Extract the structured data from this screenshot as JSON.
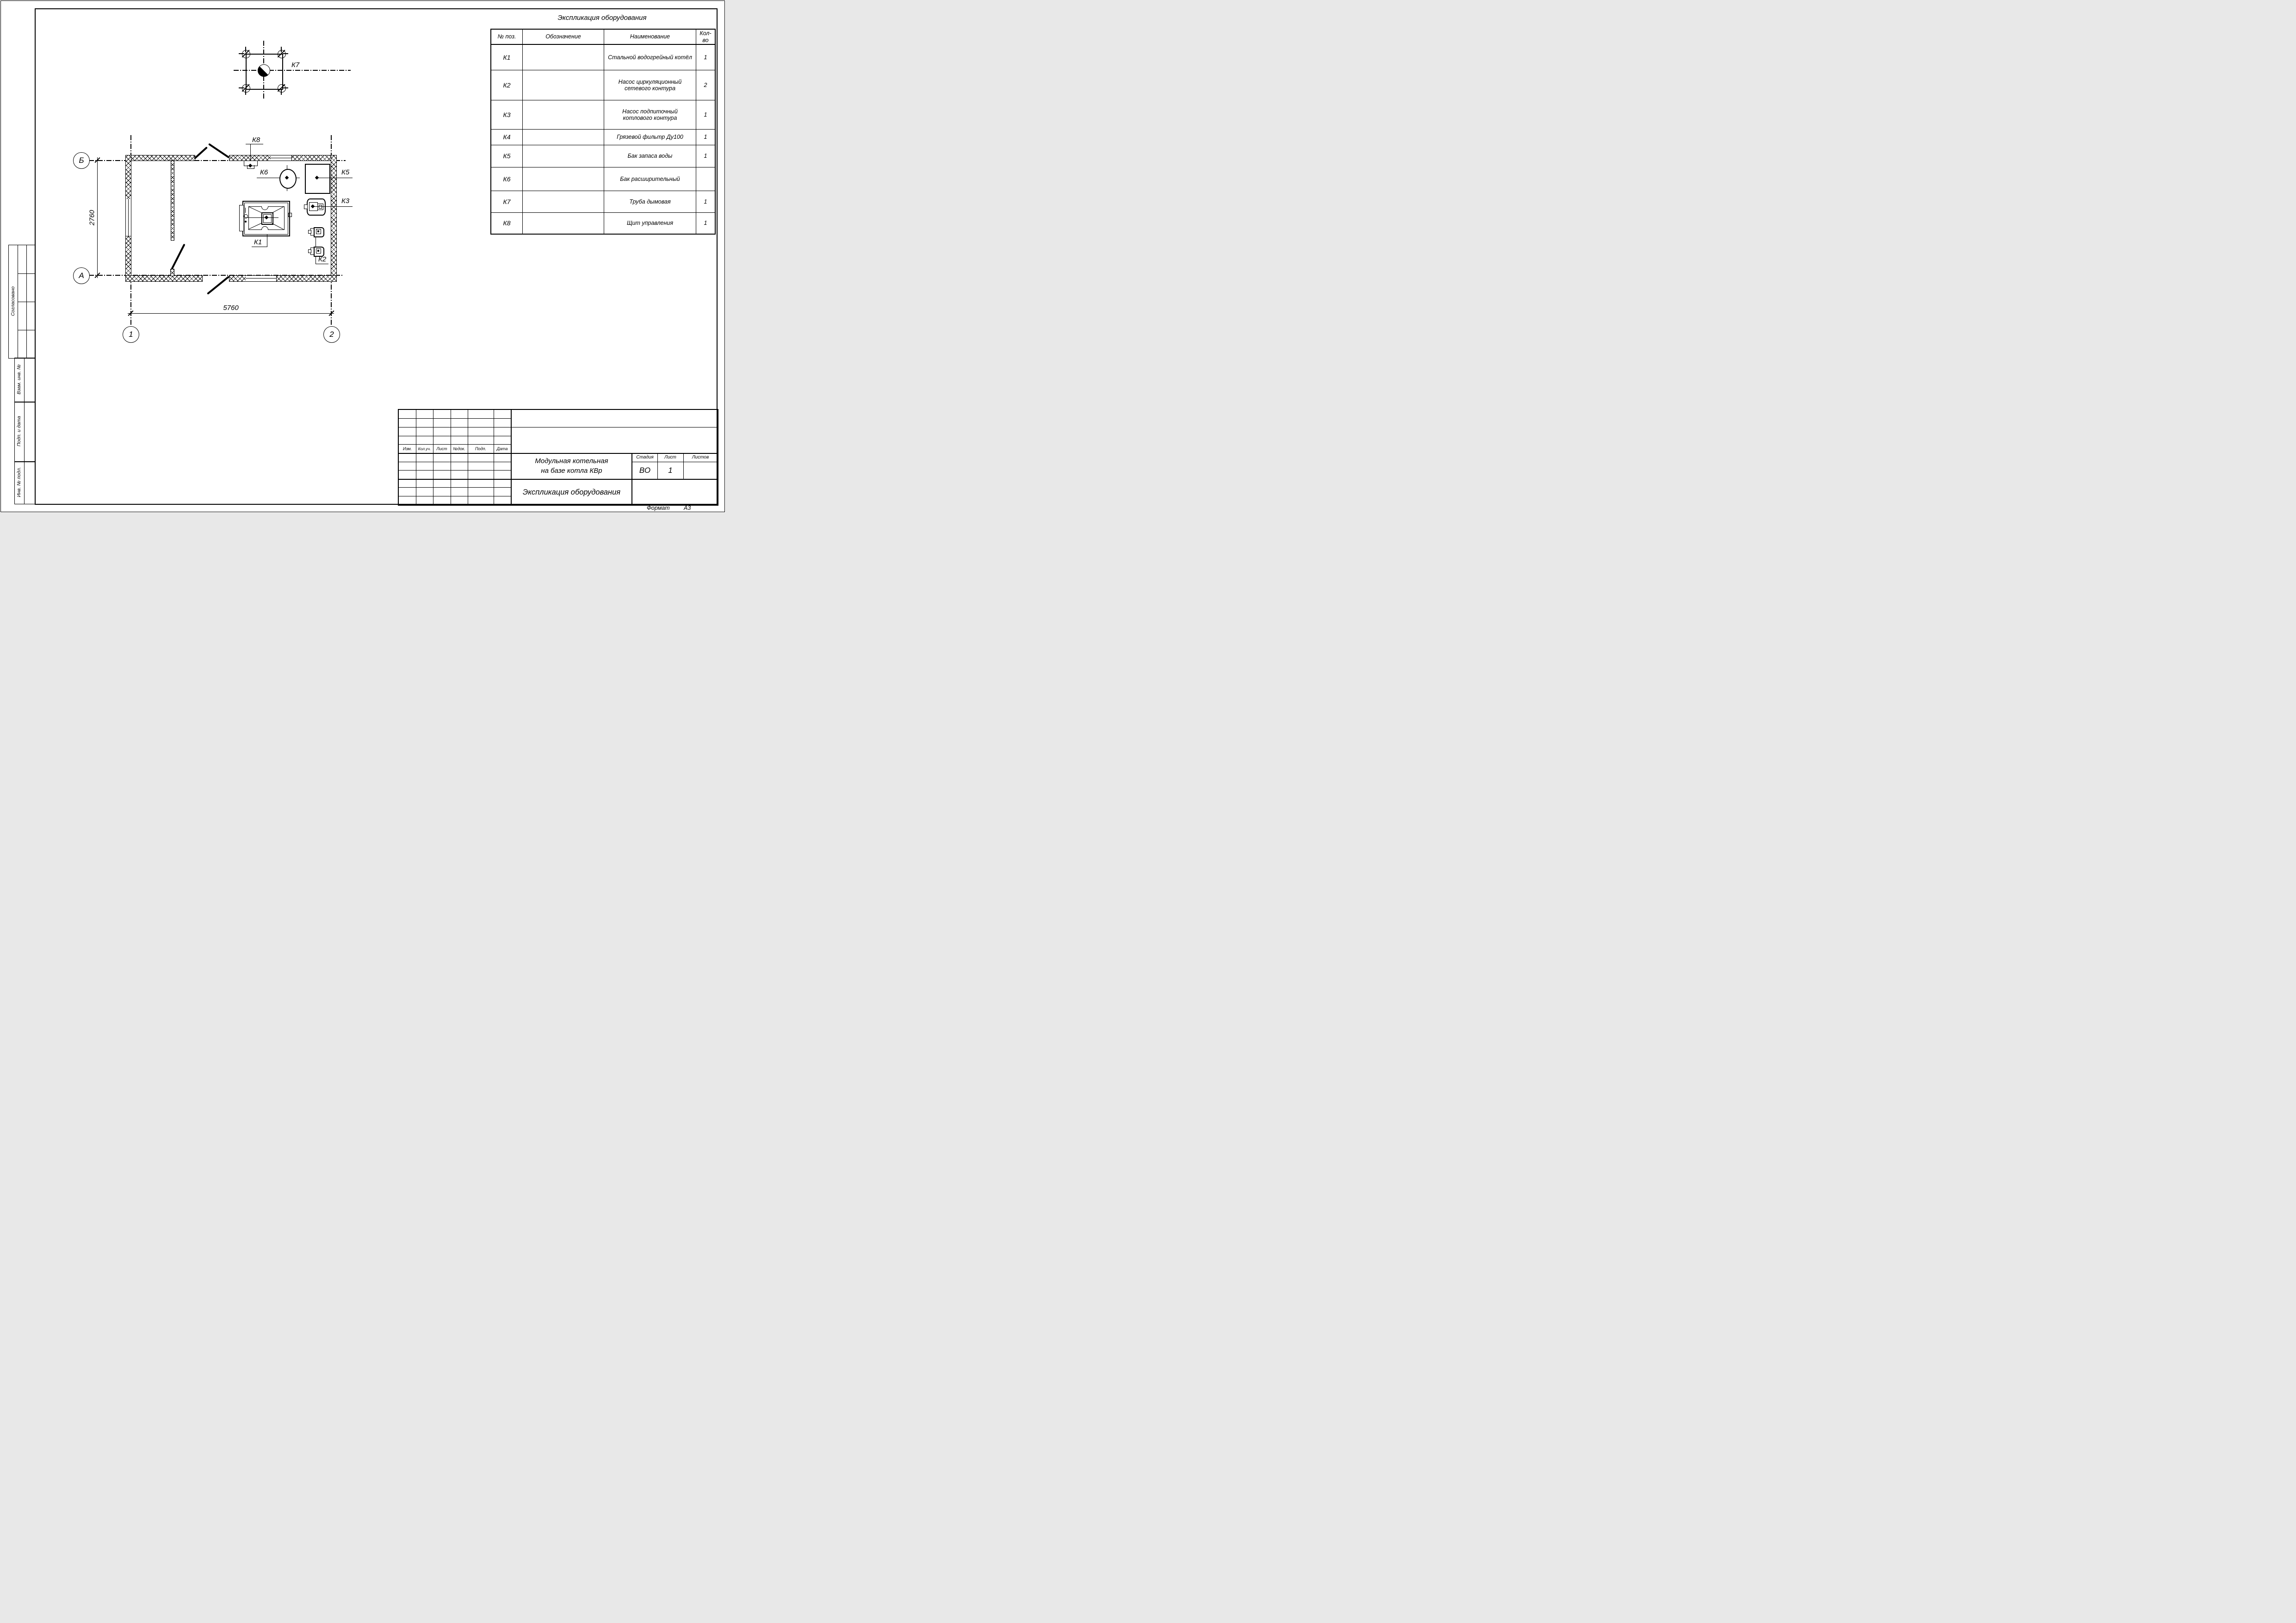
{
  "colors": {
    "ink": "#000000",
    "paper": "#ffffff"
  },
  "sheet": {
    "format_label": "Формат",
    "format_value": "А3"
  },
  "equipment_table": {
    "title": "Экспликация оборудования",
    "headers": {
      "pos": "№ поз.",
      "designation": "Обозначение",
      "name": "Наименование",
      "qty": "Кол-во"
    },
    "rows": [
      {
        "pos": "К1",
        "designation": "",
        "name": "Стальной водогрейный котёл",
        "qty": "1"
      },
      {
        "pos": "К2",
        "designation": "",
        "name": "Насос циркуляционный сетевого контура",
        "qty": "2"
      },
      {
        "pos": "К3",
        "designation": "",
        "name": "Насос подпиточный котлового контура",
        "qty": "1"
      },
      {
        "pos": "К4",
        "designation": "",
        "name": "Грязевой фильтр Ду100",
        "qty": "1"
      },
      {
        "pos": "К5",
        "designation": "",
        "name": "Бак запаса воды",
        "qty": "1"
      },
      {
        "pos": "К6",
        "designation": "",
        "name": "Бак расширительный",
        "qty": ""
      },
      {
        "pos": "К7",
        "designation": "",
        "name": "Труба дымовая",
        "qty": "1"
      },
      {
        "pos": "К8",
        "designation": "",
        "name": "Щит управления",
        "qty": "1"
      }
    ]
  },
  "plan": {
    "axes": {
      "b": "Б",
      "a": "А",
      "one": "1",
      "two": "2"
    },
    "dims": {
      "width": "5760",
      "height": "2760"
    },
    "tags": {
      "k1": "К1",
      "k2": "К2",
      "k3": "К3",
      "k5": "К5",
      "k6": "К6",
      "k7": "К7",
      "k8": "К8"
    }
  },
  "title_block": {
    "rev_headers": [
      "Изм.",
      "Кол.уч.",
      "Лист",
      "№док.",
      "Подп.",
      "Дата"
    ],
    "project_line1": "Модульная котельная",
    "project_line2": "на базе котла КВр",
    "doc_title": "Экспликация оборудования",
    "stage_label": "Стадия",
    "stage_value": "ВО",
    "sheet_label": "Лист",
    "sheet_value": "1",
    "sheets_label": "Листов",
    "sheets_value": ""
  },
  "side_stamps": {
    "agreed": "Согласовано",
    "vzam": "Взам. инв. №",
    "podp": "Подп. и дата",
    "inv": "Инв. № подл."
  }
}
